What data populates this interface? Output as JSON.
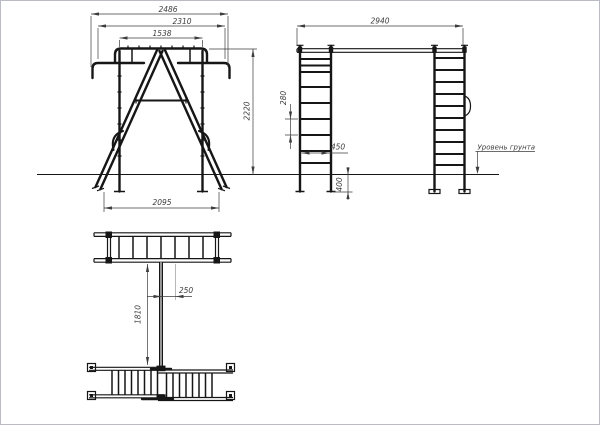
{
  "page": {
    "background": "#ffffff",
    "border_color": "#b9bcc3",
    "line_color": "#161616",
    "dimension_color": "#3d3d3d"
  },
  "drawing": {
    "type": "technical-drawing",
    "subject": "playground-monkey-bars",
    "views": {
      "front": {
        "title": "front-view",
        "dimensions": {
          "overall_width": "2486",
          "outer_width": "2310",
          "top_rail_width": "1538",
          "height": "2220",
          "base_width": "2095"
        }
      },
      "side": {
        "title": "side-view",
        "dimensions": {
          "overall_length": "2940",
          "rung_spacing": "280",
          "ladder_width": "450",
          "embedment_depth": "400"
        },
        "ground_level_label": "Уровень грунта"
      },
      "plan": {
        "title": "plan-view",
        "dimensions": {
          "rung_spacing": "250",
          "frame_length": "1810"
        }
      }
    }
  }
}
